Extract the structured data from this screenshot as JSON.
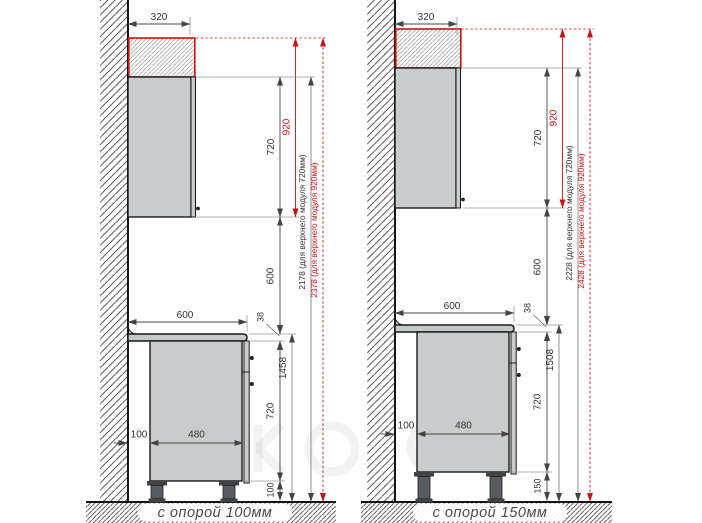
{
  "diagram_title": "kitchen base and wall cabinet mounting heights",
  "colors": {
    "accent_red": "#cc1111",
    "cabinet_fill": "#c9cccd",
    "countertop_fill": "#c5c9ca",
    "outline": "#1a1a1a",
    "dim_line": "#555555",
    "leg_dark": "#3f4345"
  },
  "drawings": [
    {
      "id": "support-100",
      "caption": "с опорой 100мм",
      "dims": {
        "top_width": "320",
        "upper_height": "720",
        "upper_height_alt": "920",
        "gap": "600",
        "counter_width": "600",
        "counter_thickness": "38",
        "floor_to_counter": "1458",
        "base_height": "720",
        "leg_height": "100",
        "back_gap": "100",
        "base_depth": "480",
        "total_std": "2178 (для верхнего модуля 720мм)",
        "total_alt": "2378 (для верхнего модуля 920мм)"
      }
    },
    {
      "id": "support-150",
      "caption": "с опорой 150мм",
      "dims": {
        "top_width": "320",
        "upper_height": "720",
        "upper_height_alt": "920",
        "gap": "600",
        "counter_width": "600",
        "counter_thickness": "38",
        "floor_to_counter": "1508",
        "base_height": "720",
        "leg_height": "150",
        "back_gap": "100",
        "base_depth": "480",
        "total_std": "2228 (для верхнего модуля 720мм)",
        "total_alt": "2428 (для верхнего модуля 920мм)"
      }
    }
  ]
}
